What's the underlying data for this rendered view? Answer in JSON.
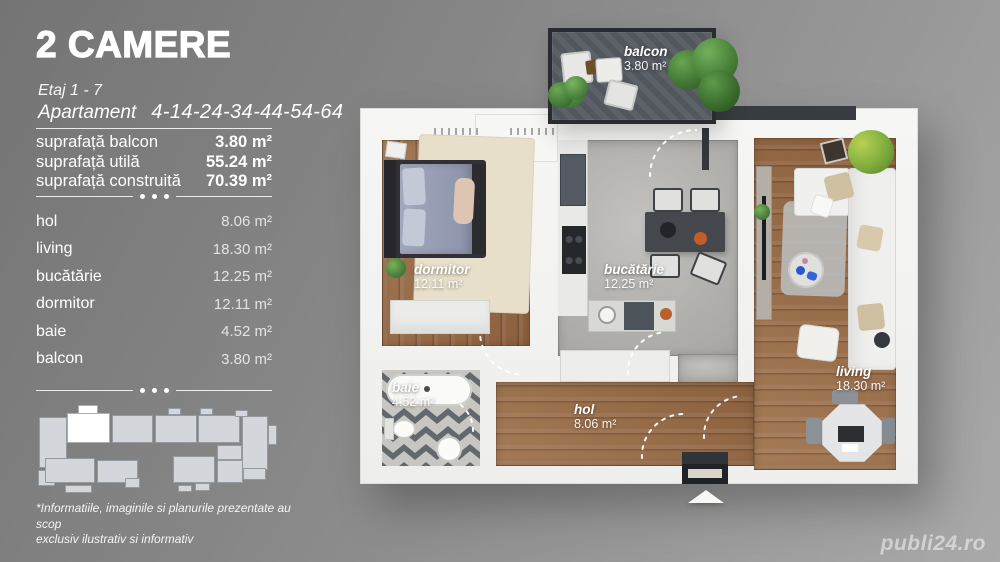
{
  "panel": {
    "title": "2 CAMERE",
    "floor": "Etaj 1 - 7",
    "apartment_label": "Apartament",
    "apartment_numbers": "4-14-24-34-44-54-64",
    "areas": [
      {
        "label": "suprafață balcon",
        "value": "3.80 m²"
      },
      {
        "label": "suprafață utilă",
        "value": "55.24 m²"
      },
      {
        "label": "suprafață construită",
        "value": "70.39 m²"
      }
    ],
    "rooms": [
      {
        "label": "hol",
        "value": "8.06 m²"
      },
      {
        "label": "living",
        "value": "18.30 m²"
      },
      {
        "label": "bucătărie",
        "value": "12.25 m²"
      },
      {
        "label": "dormitor",
        "value": "12.11 m²"
      },
      {
        "label": "baie",
        "value": "4.52 m²"
      },
      {
        "label": "balcon",
        "value": "3.80 m²"
      }
    ],
    "disclaimer": "*Informatiile, imaginile si planurile prezentate au scop\nexclusiv ilustrativ si informativ"
  },
  "plan": {
    "labels": {
      "balcon": {
        "name": "balcon",
        "area": "3.80 m²"
      },
      "dormitor": {
        "name": "dormitor",
        "area": "12.11 m²"
      },
      "bucatarie": {
        "name": "bucătărie",
        "area": "12.25 m²"
      },
      "living": {
        "name": "living",
        "area": "18.30 m²"
      },
      "baie": {
        "name": "baie",
        "area": "4.52 m²"
      },
      "hol": {
        "name": "hol",
        "area": "8.06 m²"
      }
    }
  },
  "watermark": "publi24.ro",
  "colors": {
    "background_top": "#747474",
    "background_bottom": "#a9a9a9",
    "text": "#ffffff",
    "wall": "#f3f3f2",
    "wood_floor": "#9a6b44",
    "kitchen_floor": "#b3b2ae",
    "tile_dark": "#63686d",
    "tile_light": "#c7c6c2",
    "balcony_floor": "#565b62",
    "footprint_block": "#d3d6da",
    "footprint_highlight": "#ffffff",
    "watermark": "#dcdcdc"
  }
}
